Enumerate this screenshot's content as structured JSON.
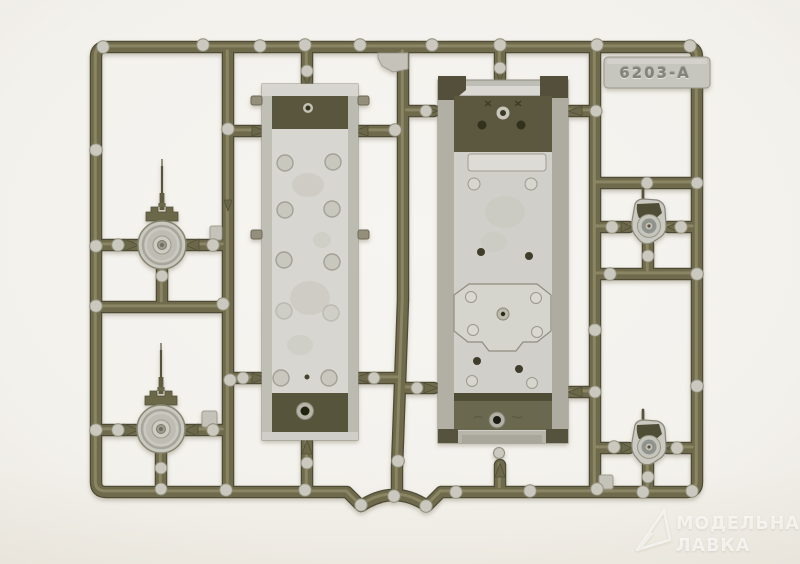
{
  "scene": {
    "description": "Photograph of an olive-green injection-molded plastic model kit sprue holding two tank hull parts, two round road wheels with thin molded pins, and two teardrop-shaped final-drive housings, on a white studio background",
    "sprue_number": "6203-A"
  },
  "tag": {
    "label": "6203-A"
  },
  "watermark": {
    "line1": "МОДЕЛЬНАЯ",
    "line2": "ЛАВКА",
    "logo_icon": "paper-plane-logo"
  },
  "palette": {
    "background": "#f5f3ef",
    "background_edge": "#edeae3",
    "sprue_olive": "#6e6a4c",
    "sprue_shadow": "#4e4b35",
    "sprue_highlight": "#8f8a68",
    "ejector_pad": "#cac8bf",
    "part_light_gray": "#d5d4ce",
    "part_dark_olive": "#5a573e",
    "tag_gray": "#c7c6be",
    "watermark_white": "#ffffff"
  }
}
